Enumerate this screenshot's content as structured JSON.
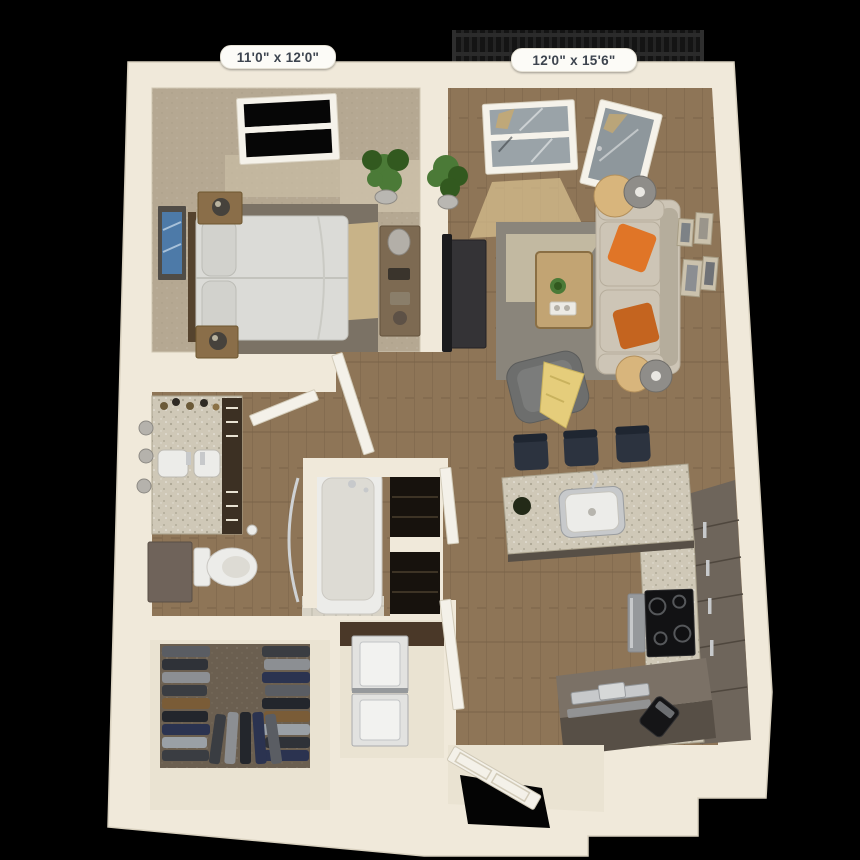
{
  "scene": {
    "kind": "3d-apartment-floor-plan-render",
    "background": "#000000"
  },
  "labels": {
    "bedroom_dimensions": "11'0\" x 12'0\"",
    "living_dimensions": "12'0\" x 15'6\""
  },
  "colors": {
    "background": "#000000",
    "wall": "#f0e9da",
    "wall_edge": "#d5cbb6",
    "floor_cream": "#eae3d2",
    "carpet": "#b5a892",
    "carpet_light": "#cdc1a9",
    "rug_bedroom": "#7b7265",
    "rug_living": "#8a857b",
    "sun_patch": "#dcc391",
    "wood": "#8e7557",
    "wood_dark": "#6e5940",
    "bed_linen": "#dbdbd7",
    "pillow": "#d2d2cd",
    "headboard": "#55432e",
    "nightstand": "#8a6e49",
    "dresser": "#7d6a52",
    "art_frame": "#504c46",
    "art_blue": "#4d7aa8",
    "plant": "#4b7a37",
    "plant_dark": "#32591f",
    "pot": "#b9b7b2",
    "glass": "#9aa3a8",
    "glass_dark": "#8e979c",
    "frame_white": "#f5f2ea",
    "railing": "#141414",
    "railing_bar": "#2b2b2b",
    "sofa": "#cdc5b6",
    "sofa_shade": "#b3aa99",
    "orange": "#e07527",
    "orange_dark": "#c4641f",
    "lamp_shade": "#8f8d89",
    "lamp_inner": "#e9e7e2",
    "table_wood": "#c2a473",
    "tv": "#1b1b1d",
    "console": "#343336",
    "armchair": "#6d6e6d",
    "armchair_dark": "#565756",
    "throw": "#e5cd7b",
    "granite": "#cfc8b7",
    "granite_dark": "#a9a18c",
    "cabinet_taupe": "#6e655b",
    "cabinet_taupe_dark": "#574f46",
    "cabinet_brown": "#3c3023",
    "cabinet_gray": "#6f635a",
    "stool": "#2c333f",
    "stool_dark": "#1f2631",
    "steel": "#c7c9cb",
    "steel_dark": "#96999c",
    "fixture_white": "#ecece9",
    "tile": "#d8d3c6",
    "tile_line": "#bdb8aa",
    "closet_carpet": "#6b5f50",
    "clothes_a": "#5a5d63",
    "clothes_b": "#2f3238",
    "clothes_c": "#8c8f93",
    "clothes_d": "#3a3d42",
    "clothes_e": "#7a5c37",
    "clothes_f": "#2b3350",
    "clothes_g": "#9aa0a6",
    "clothes_h": "#23262c",
    "stove": "#121214",
    "door": "#f4f1e9",
    "door_line": "#d3ccba",
    "opening": "#040404",
    "laundry_wall": "#4a3828",
    "washer": "#e2e2e0",
    "washer_line": "#a9abad",
    "label_bg": "#fcfbf7",
    "label_text": "#3d444f"
  }
}
